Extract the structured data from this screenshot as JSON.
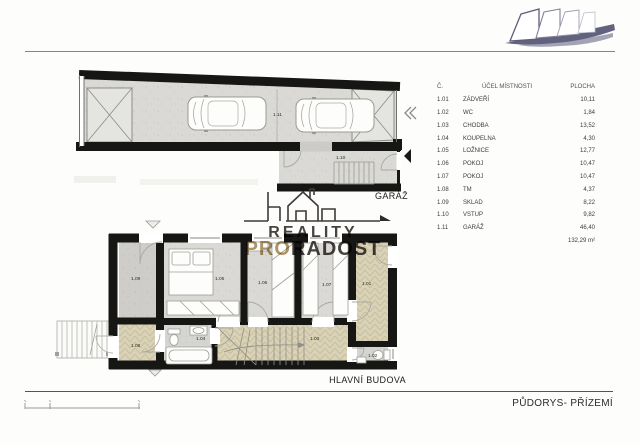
{
  "header": {
    "page_title": "PŮDORYS- PŘÍZEMÍ"
  },
  "plan_titles": {
    "garage": "GARÁŽ",
    "main_building": "HLAVNÍ BUDOVA"
  },
  "watermark": {
    "line1": "REALITY",
    "pro": "PRO",
    "radost": "RADOST"
  },
  "icons": {
    "double_chevron_left": "«",
    "entry_arrow_left": "◀",
    "entrance_marker": "▽",
    "brand_logo": "sail-sketch-logo",
    "watermark_house": "house-skyline-icon"
  },
  "room_labels": {
    "r111": "1.11",
    "r110": "1.10",
    "r109": "1.09",
    "r105": "1.05",
    "r106": "1.06",
    "r107": "1.07",
    "r101": "1.01",
    "r108": "1.08",
    "r104": "1.04",
    "r103": "1.03",
    "r102": "1.02"
  },
  "table": {
    "headers": {
      "num": "Č.",
      "purpose": "ÚČEL MÍSTNOSTI",
      "area": "PLOCHA"
    },
    "rows": [
      {
        "num": "1.01",
        "name": "ZÁDVEŘÍ",
        "area": "10,11"
      },
      {
        "num": "1.02",
        "name": "WC",
        "area": "1,84"
      },
      {
        "num": "1.03",
        "name": "CHODBA",
        "area": "13,52"
      },
      {
        "num": "1.04",
        "name": "KOUPELNA",
        "area": "4,30"
      },
      {
        "num": "1.05",
        "name": "LOŽNICE",
        "area": "12,77"
      },
      {
        "num": "1.06",
        "name": "POKOJ",
        "area": "10,47"
      },
      {
        "num": "1.07",
        "name": "POKOJ",
        "area": "10,47"
      },
      {
        "num": "1.08",
        "name": "TM",
        "area": "4,37"
      },
      {
        "num": "1.09",
        "name": "SKLAD",
        "area": "8,22"
      },
      {
        "num": "1.10",
        "name": "VSTUP",
        "area": "9,82"
      },
      {
        "num": "1.11",
        "name": "GARÁŽ",
        "area": "46,40"
      }
    ],
    "total": "132,29 m²"
  },
  "colors": {
    "wall": "#161614",
    "concrete_floor": "#dad9d5",
    "storage_floor": "#cecdc9",
    "parquet_floor": "#d9d2b6",
    "tile_floor": "#d5d5d2",
    "watermark_dark": "#3a3430",
    "watermark_bronze": "#aa8c5c",
    "logo_grey": "#62627e"
  }
}
